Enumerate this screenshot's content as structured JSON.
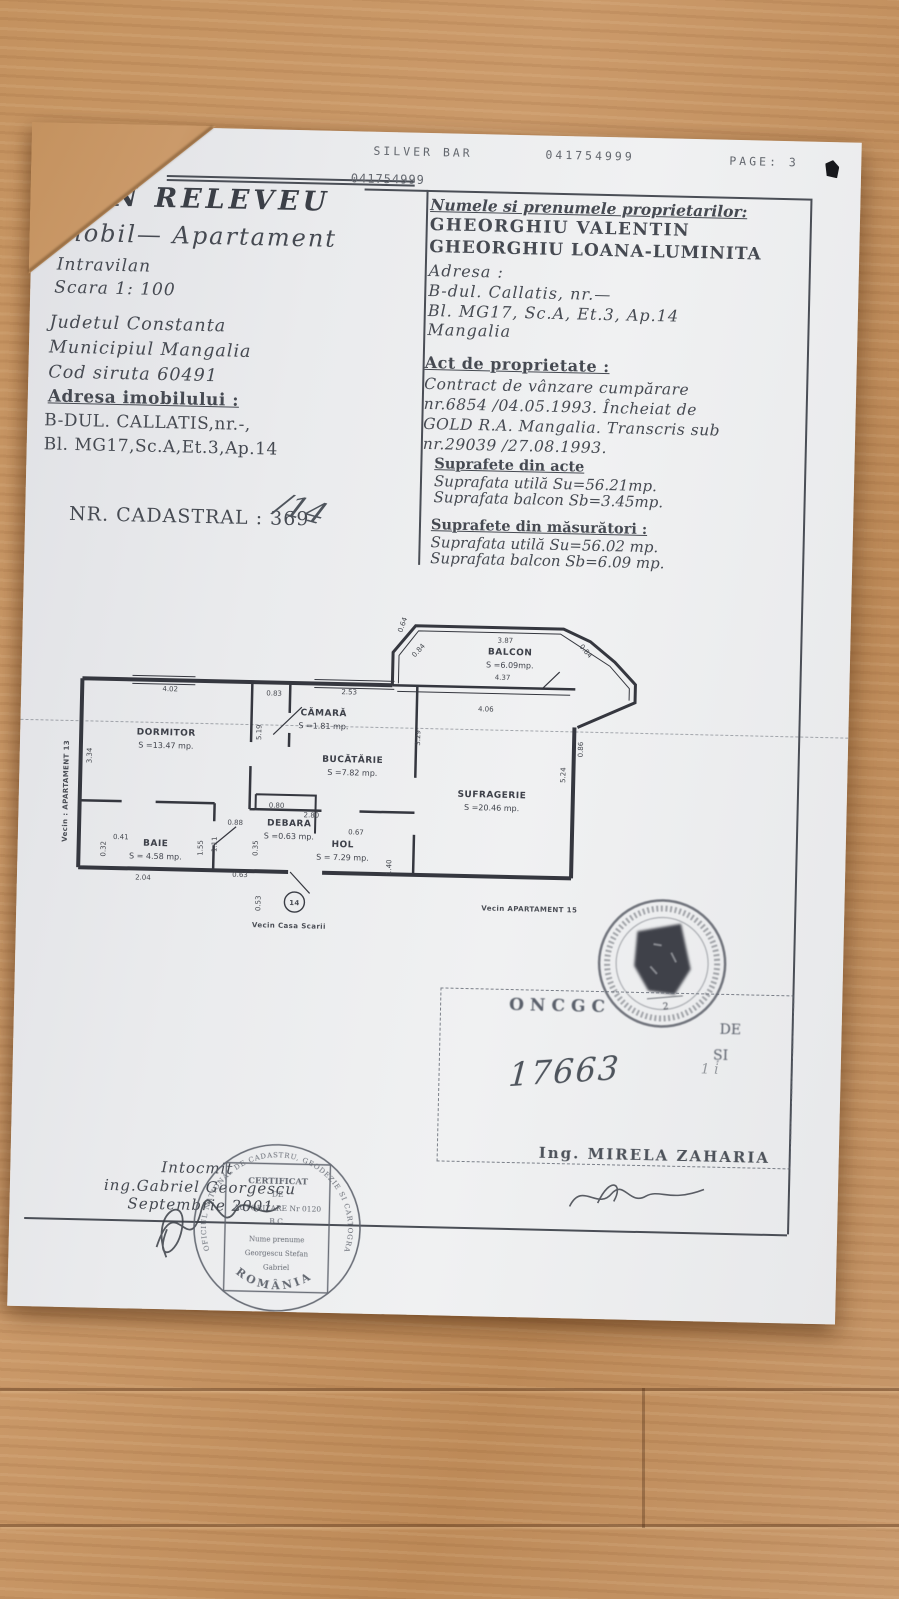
{
  "colors": {
    "wood": "#c4925f",
    "paper": "#ecedef",
    "ink": "#464a52",
    "plan_line": "#35373f",
    "stamp_ink": "#5a5f68"
  },
  "fax_header": {
    "code": "8134",
    "station": "SILVER BAR",
    "number": "041754999",
    "page": "PAGE: 3"
  },
  "fax_inline": "041754999",
  "title_block": {
    "title": "PLAN RELEVEU",
    "subtitle": "Imobil— Apartament",
    "line3": "Intravilan",
    "line4": "Scara 1: 100"
  },
  "location_block": {
    "county": "Judetul Constanta",
    "city": "Municipiul Mangalia",
    "siruta": "Cod siruta 60491"
  },
  "address_block": {
    "heading": "Adresa imobilului :",
    "line1": "B-DUL. CALLATIS,nr.-,",
    "line2": "Bl. MG17,Sc.A,Et.3,Ap.14"
  },
  "cadastral": {
    "label": "NR. CADASTRAL : 369",
    "handwritten": "/14"
  },
  "owners_box": {
    "heading": "Numele si prenumele proprietarilor:",
    "owner1": "GHEORGHIU VALENTIN",
    "owner2": "GHEORGHIU LOANA-LUMINITA",
    "address_label": "Adresa :",
    "address1": "B-dul. Callatis, nr.—",
    "address2": "Bl. MG17, Sc.A, Et.3, Ap.14",
    "address3": "Mangalia"
  },
  "property_act": {
    "heading": "Act de proprietate :",
    "line1": "Contract de vânzare cumpărare",
    "line2": "nr.6854 /04.05.1993. Încheiat de",
    "line3": "GOLD R.A. Mangalia. Transcris sub",
    "line4": "nr.29039 /27.08.1993."
  },
  "areas_from_acts": {
    "heading": "Suprafete din acte",
    "line1": "Suprafata utilă Su=56.21mp.",
    "line2": "Suprafata balcon Sb=3.45mp."
  },
  "areas_measured": {
    "heading": "Suprafete din măsurători :",
    "line1": "Suprafata utilă Su=56.02 mp.",
    "line2": "Suprafata balcon Sb=6.09 mp."
  },
  "plan": {
    "rooms": [
      {
        "name": "DORMITOR",
        "area": "S =13.47 mp.",
        "x": 105,
        "y": 143
      },
      {
        "name": "CĂMARĂ",
        "area": "S =1.81 mp.",
        "x": 262,
        "y": 120
      },
      {
        "name": "BUCĂTĂRIE",
        "area": "S =7.82 mp.",
        "x": 292,
        "y": 166
      },
      {
        "name": "SUFRAGERIE",
        "area": "S =20.46 mp.",
        "x": 432,
        "y": 198
      },
      {
        "name": "BALCON",
        "area": "S =6.09mp.",
        "x": 447,
        "y": 55
      },
      {
        "name": "BAIE",
        "area": "S = 4.58 mp.",
        "x": 97,
        "y": 254
      },
      {
        "name": "DEBARA",
        "area": "S =0.63 mp.",
        "x": 230,
        "y": 231
      },
      {
        "name": "HOL",
        "area": "S = 7.29 mp.",
        "x": 284,
        "y": 251
      }
    ],
    "dimensions": [
      {
        "t": "4.02",
        "x": 108,
        "y": 99,
        "r": 0
      },
      {
        "t": "0.83",
        "x": 212,
        "y": 101,
        "r": 0
      },
      {
        "t": "2.53",
        "x": 287,
        "y": 98,
        "r": 0
      },
      {
        "t": "4.06",
        "x": 424,
        "y": 112,
        "r": 0
      },
      {
        "t": "3.87",
        "x": 442,
        "y": 43,
        "r": 0
      },
      {
        "t": "4.37",
        "x": 440,
        "y": 80,
        "r": 0
      },
      {
        "t": "0.64",
        "x": 341,
        "y": 28,
        "r": -72
      },
      {
        "t": "0.84",
        "x": 357,
        "y": 54,
        "r": -48
      },
      {
        "t": "0.84",
        "x": 521,
        "y": 51,
        "r": 48
      },
      {
        "t": "3.34",
        "x": 31,
        "y": 165,
        "r": -90
      },
      {
        "t": "5.19",
        "x": 200,
        "y": 138,
        "r": -90
      },
      {
        "t": "3.29",
        "x": 359,
        "y": 140,
        "r": -90
      },
      {
        "t": "0.86",
        "x": 522,
        "y": 148,
        "r": -90
      },
      {
        "t": "5.24",
        "x": 505,
        "y": 174,
        "r": -90
      },
      {
        "t": "0.41",
        "x": 62,
        "y": 248,
        "r": 0
      },
      {
        "t": "0.32",
        "x": 47,
        "y": 258,
        "r": -90
      },
      {
        "t": "1.55",
        "x": 144,
        "y": 255,
        "r": -90
      },
      {
        "t": "1.11",
        "x": 158,
        "y": 251,
        "r": -90
      },
      {
        "t": "0.88",
        "x": 176,
        "y": 231,
        "r": 0
      },
      {
        "t": "0.80",
        "x": 217,
        "y": 213,
        "r": 0
      },
      {
        "t": "2.80",
        "x": 252,
        "y": 222,
        "r": 0
      },
      {
        "t": "0.35",
        "x": 199,
        "y": 254,
        "r": -90
      },
      {
        "t": "0.67",
        "x": 297,
        "y": 238,
        "r": 0
      },
      {
        "t": "1.40",
        "x": 333,
        "y": 270,
        "r": -90
      },
      {
        "t": "0.63",
        "x": 182,
        "y": 283,
        "r": 0
      },
      {
        "t": "0.53",
        "x": 203,
        "y": 309,
        "r": -90
      },
      {
        "t": "2.04",
        "x": 85,
        "y": 288,
        "r": 0
      }
    ],
    "labels": {
      "apartment_circle": "14",
      "neighbor_stairs": "Vecin Casa Scarii",
      "neighbor_bottom": "Vecin APARTAMENT 15",
      "neighbor_left": "Vecin : APARTAMENT 13"
    }
  },
  "footer": {
    "line1": "Intocmit",
    "line2": "ing.Gabriel Georgescu",
    "line3": "Septembrie 2001"
  },
  "round_stamp": {
    "ring_text": "OFICIUL NATIONAL DE CADASTRU, GEODEZIE SI CARTOGRAFIE",
    "country": "ROMÂNIA",
    "cert1": "CERTIFICAT",
    "cert2": "DE",
    "cert3": "AUTORIZARE Nr 0120",
    "cert4": "B.C.",
    "cert5": "Nume prenume",
    "cert6": "Georgescu Stefan",
    "cert7": "Gabriel"
  },
  "approval_box": {
    "faint1": "ONCGC",
    "faint2": "DE",
    "faint3": "ȘI",
    "handwritten_number": "17663",
    "handwritten_note": "1 i",
    "engineer": "Ing. MIRELA ZAHARIA"
  },
  "ink_stamp": {
    "number": "2"
  }
}
